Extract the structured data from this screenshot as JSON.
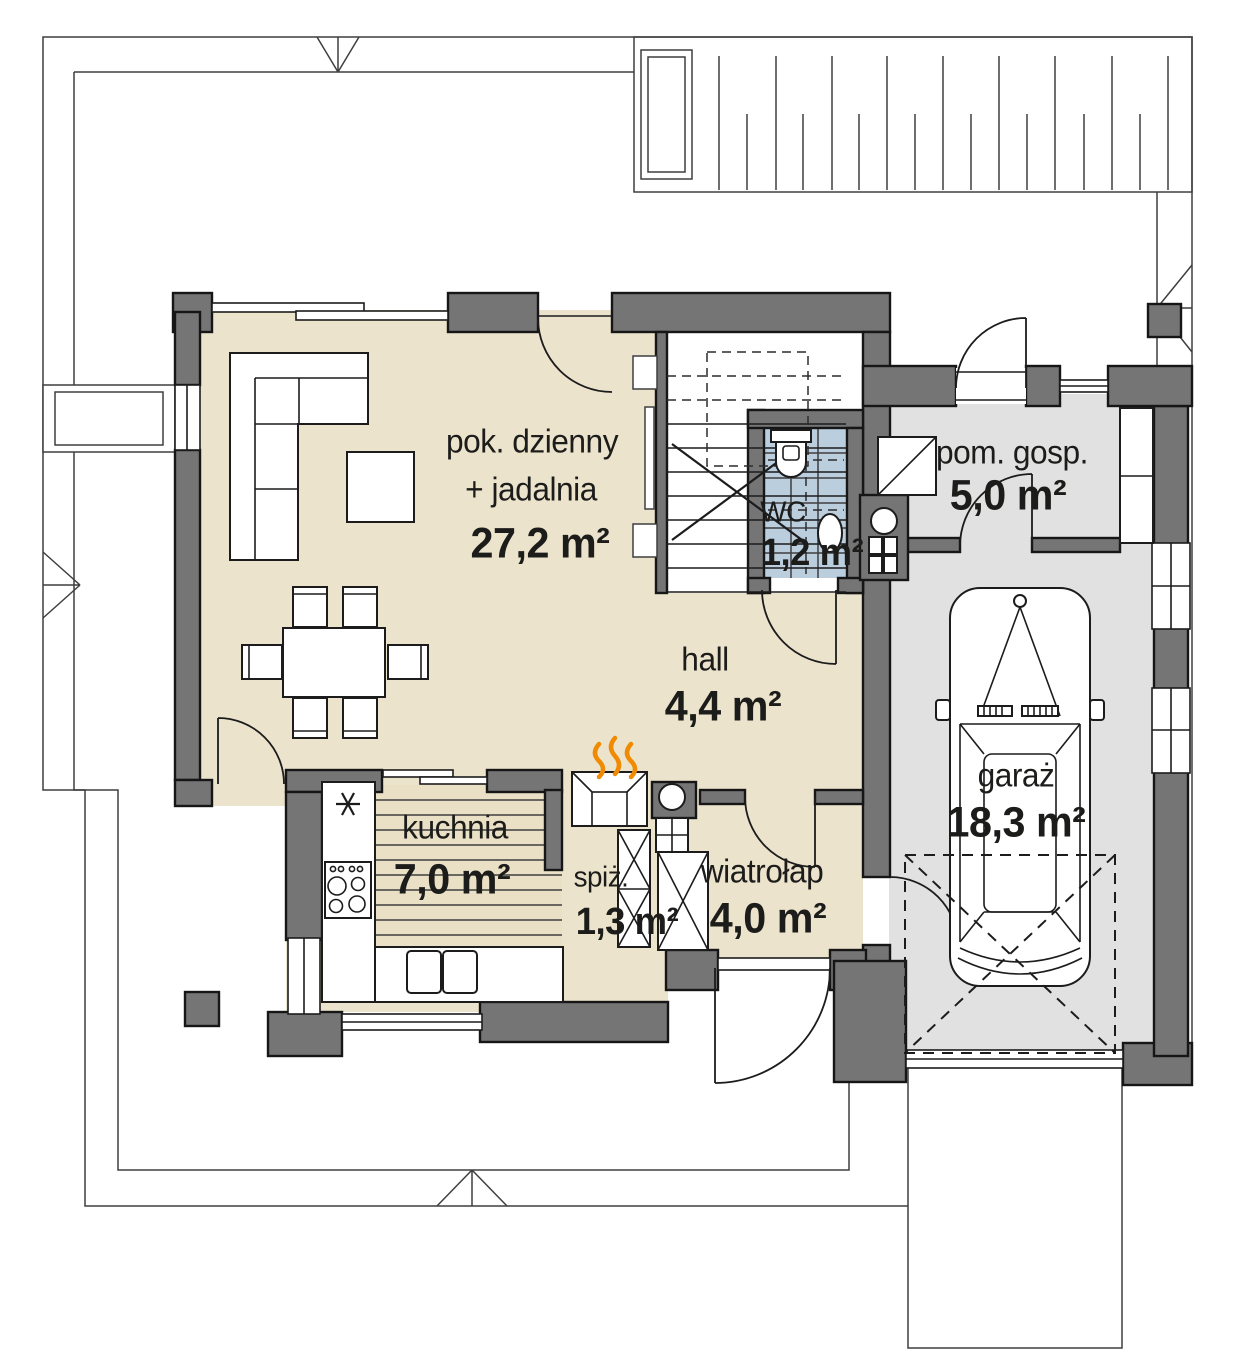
{
  "plan": {
    "rooms": {
      "living": {
        "name_line1": "pok. dzienny",
        "name_line2": "+ jadalnia",
        "area": "27,2 m²"
      },
      "stair_wc": {
        "name": "WC",
        "area": "1,2 m²"
      },
      "utility": {
        "name": "pom. gosp.",
        "area": "5,0 m²"
      },
      "hall": {
        "name": "hall",
        "area": "4,4 m²"
      },
      "kitchen": {
        "name": "kuchnia",
        "area": "7,0 m²"
      },
      "pantry": {
        "name": "spiż.",
        "area": "1,3 m²"
      },
      "vestibule": {
        "name": "wiatrołap",
        "area": "4,0 m²"
      },
      "garage": {
        "name": "garaż",
        "area": "18,3 m²"
      }
    },
    "colors": {
      "wall": "#757575",
      "beige": "#ece3cd",
      "gray": "#e1e1e1",
      "tile": "#bacedd",
      "flame": "#f08a00"
    }
  }
}
